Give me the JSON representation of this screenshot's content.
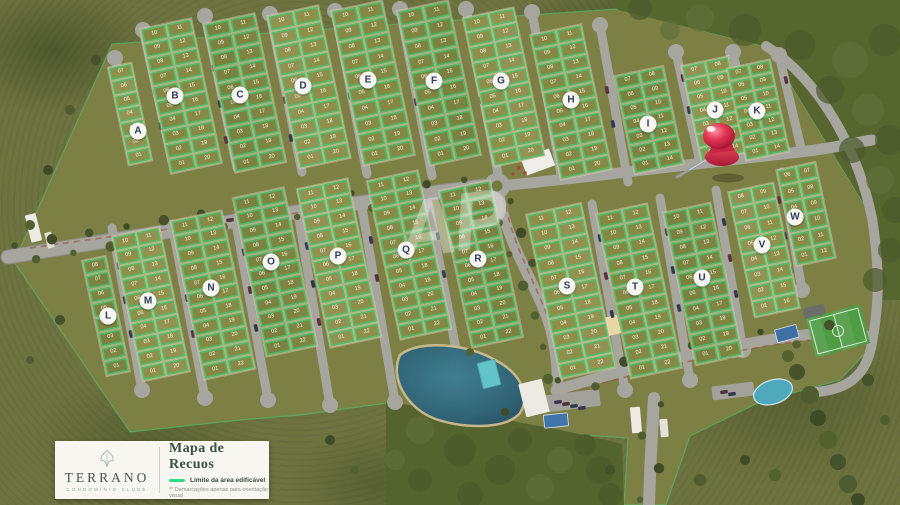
{
  "legend": {
    "brand": "TERRANO",
    "brand_tagline": "CONDOMÍNIO CLUBE",
    "brand_icon": "leaf-icon",
    "title": "Mapa de Recuos",
    "line_label": "Limite da área edificável",
    "note": "** Demarcações apenas para orientação visual"
  },
  "watermark": "AP",
  "pin": {
    "icon": "map-pin-icon",
    "color": "#d82f48"
  },
  "colors": {
    "limit_green": "#2fd987",
    "road_gray": "#a6a59e",
    "lot_olive": "#878a45",
    "lagoon_blue": "#2f6478",
    "field_green": "#4e9c44",
    "forest_dark": "#55632f"
  },
  "blocks": [
    {
      "label": "A",
      "cx": 130,
      "cy": 114,
      "w": 24,
      "h": 100,
      "rows": 7,
      "cols": 1,
      "mx": 138,
      "my": 131,
      "lots": [
        "07",
        "06",
        "05",
        "04",
        "03",
        "02",
        "01"
      ]
    },
    {
      "label": "B",
      "cx": 181,
      "cy": 96,
      "w": 52,
      "h": 148,
      "rows": 10,
      "cols": 2,
      "mx": 175,
      "my": 96,
      "lots": [
        "10",
        "11",
        "09",
        "12",
        "08",
        "13",
        "07",
        "14",
        "06",
        "15",
        "05",
        "16",
        "04",
        "17",
        "03",
        "18",
        "02",
        "19",
        "01",
        "20"
      ]
    },
    {
      "label": "C",
      "cx": 245,
      "cy": 93,
      "w": 52,
      "h": 152,
      "rows": 10,
      "cols": 2,
      "mx": 240,
      "my": 95,
      "lots": [
        "10",
        "11",
        "09",
        "12",
        "08",
        "13",
        "07",
        "14",
        "06",
        "15",
        "05",
        "16",
        "04",
        "17",
        "03",
        "18",
        "02",
        "19",
        "01",
        "20"
      ]
    },
    {
      "label": "D",
      "cx": 309,
      "cy": 87,
      "w": 52,
      "h": 156,
      "rows": 10,
      "cols": 2,
      "mx": 303,
      "my": 86,
      "lots": [
        "10",
        "11",
        "09",
        "12",
        "08",
        "13",
        "07",
        "14",
        "06",
        "15",
        "05",
        "16",
        "04",
        "17",
        "03",
        "18",
        "02",
        "19",
        "01",
        "20"
      ]
    },
    {
      "label": "E",
      "cx": 373,
      "cy": 83,
      "w": 52,
      "h": 158,
      "rows": 10,
      "cols": 2,
      "mx": 368,
      "my": 80,
      "lots": [
        "10",
        "11",
        "09",
        "12",
        "08",
        "13",
        "07",
        "14",
        "06",
        "15",
        "05",
        "16",
        "04",
        "17",
        "03",
        "18",
        "02",
        "19",
        "01",
        "20"
      ]
    },
    {
      "label": "F",
      "cx": 439,
      "cy": 83,
      "w": 52,
      "h": 158,
      "rows": 10,
      "cols": 2,
      "mx": 434,
      "my": 81,
      "lots": [
        "10",
        "11",
        "09",
        "12",
        "08",
        "13",
        "07",
        "14",
        "06",
        "15",
        "05",
        "16",
        "04",
        "17",
        "03",
        "18",
        "02",
        "19",
        "01",
        "20"
      ]
    },
    {
      "label": "G",
      "cx": 504,
      "cy": 87,
      "w": 52,
      "h": 152,
      "rows": 10,
      "cols": 2,
      "mx": 501,
      "my": 81,
      "lots": [
        "10",
        "11",
        "09",
        "12",
        "08",
        "13",
        "07",
        "14",
        "06",
        "15",
        "05",
        "16",
        "04",
        "17",
        "03",
        "18",
        "02",
        "19",
        "01",
        "20"
      ]
    },
    {
      "label": "H",
      "cx": 571,
      "cy": 102,
      "w": 52,
      "h": 148,
      "rows": 10,
      "cols": 2,
      "mx": 571,
      "my": 100,
      "lots": [
        "10",
        "11",
        "09",
        "12",
        "08",
        "13",
        "07",
        "14",
        "06",
        "15",
        "05",
        "16",
        "04",
        "17",
        "03",
        "18",
        "02",
        "19",
        "01",
        "20"
      ]
    },
    {
      "label": "I",
      "cx": 649,
      "cy": 120,
      "w": 50,
      "h": 100,
      "rows": 7,
      "cols": 2,
      "mx": 648,
      "my": 124,
      "lots": [
        "07",
        "08",
        "06",
        "09",
        "05",
        "10",
        "04",
        "11",
        "03",
        "12",
        "02",
        "13",
        "01",
        "14"
      ]
    },
    {
      "label": "J",
      "cx": 715,
      "cy": 109,
      "w": 48,
      "h": 98,
      "rows": 7,
      "cols": 2,
      "mx": 715,
      "my": 110,
      "lots": [
        "07",
        "08",
        "06",
        "09",
        "05",
        "10",
        "04",
        "11",
        "03",
        "12",
        "02",
        "13",
        "01",
        "14"
      ]
    },
    {
      "label": "K",
      "cx": 758,
      "cy": 110,
      "w": 44,
      "h": 94,
      "rows": 7,
      "cols": 2,
      "mx": 757,
      "my": 111,
      "lots": [
        "07",
        "08",
        "06",
        "09",
        "05",
        "10",
        "04",
        "11",
        "03",
        "12",
        "02",
        "13",
        "01",
        "14"
      ]
    },
    {
      "label": "L",
      "cx": 106,
      "cy": 316,
      "w": 24,
      "h": 118,
      "rows": 8,
      "cols": 1,
      "mx": 108,
      "my": 316,
      "lots": [
        "08",
        "07",
        "06",
        "05",
        "04",
        "03",
        "02",
        "01"
      ]
    },
    {
      "label": "M",
      "cx": 151,
      "cy": 304,
      "w": 48,
      "h": 148,
      "rows": 10,
      "cols": 2,
      "mx": 148,
      "my": 301,
      "lots": [
        "10",
        "11",
        "09",
        "12",
        "08",
        "13",
        "07",
        "14",
        "06",
        "15",
        "05",
        "16",
        "04",
        "17",
        "03",
        "18",
        "02",
        "19",
        "01",
        "20"
      ]
    },
    {
      "label": "N",
      "cx": 213,
      "cy": 295,
      "w": 52,
      "h": 162,
      "rows": 11,
      "cols": 2,
      "mx": 211,
      "my": 288,
      "lots": [
        "11",
        "12",
        "10",
        "13",
        "09",
        "14",
        "08",
        "15",
        "07",
        "16",
        "06",
        "17",
        "05",
        "18",
        "04",
        "19",
        "03",
        "20",
        "02",
        "21",
        "01",
        "22"
      ]
    },
    {
      "label": "O",
      "cx": 275,
      "cy": 272,
      "w": 52,
      "h": 162,
      "rows": 11,
      "cols": 2,
      "mx": 271,
      "my": 262,
      "lots": [
        "11",
        "12",
        "10",
        "13",
        "09",
        "14",
        "08",
        "15",
        "07",
        "16",
        "06",
        "17",
        "05",
        "18",
        "04",
        "19",
        "03",
        "20",
        "02",
        "21",
        "01",
        "22"
      ]
    },
    {
      "label": "P",
      "cx": 339,
      "cy": 263,
      "w": 52,
      "h": 162,
      "rows": 11,
      "cols": 2,
      "mx": 338,
      "my": 256,
      "lots": [
        "11",
        "12",
        "10",
        "13",
        "09",
        "14",
        "08",
        "15",
        "07",
        "16",
        "06",
        "17",
        "05",
        "18",
        "04",
        "19",
        "03",
        "20",
        "02",
        "21",
        "01",
        "22"
      ]
    },
    {
      "label": "Q",
      "cx": 409,
      "cy": 255,
      "w": 52,
      "h": 162,
      "rows": 11,
      "cols": 2,
      "mx": 406,
      "my": 250,
      "lots": [
        "11",
        "12",
        "10",
        "13",
        "09",
        "14",
        "08",
        "15",
        "07",
        "16",
        "06",
        "17",
        "05",
        "18",
        "04",
        "19",
        "03",
        "20",
        "02",
        "21",
        "01",
        "22"
      ]
    },
    {
      "label": "R",
      "cx": 481,
      "cy": 264,
      "w": 52,
      "h": 160,
      "rows": 11,
      "cols": 2,
      "mx": 478,
      "my": 259,
      "lots": [
        "11",
        "12",
        "10",
        "13",
        "09",
        "14",
        "08",
        "15",
        "07",
        "16",
        "06",
        "17",
        "05",
        "18",
        "04",
        "19",
        "03",
        "20",
        "02",
        "21",
        "01",
        "22"
      ]
    },
    {
      "label": "S",
      "cx": 571,
      "cy": 291,
      "w": 56,
      "h": 168,
      "rows": 11,
      "cols": 2,
      "mx": 567,
      "my": 286,
      "lots": [
        "11",
        "12",
        "10",
        "13",
        "09",
        "14",
        "08",
        "15",
        "07",
        "16",
        "06",
        "17",
        "05",
        "18",
        "04",
        "19",
        "03",
        "20",
        "02",
        "21",
        "01",
        "22"
      ]
    },
    {
      "label": "T",
      "cx": 639,
      "cy": 291,
      "w": 52,
      "h": 168,
      "rows": 11,
      "cols": 2,
      "mx": 635,
      "my": 287,
      "lots": [
        "11",
        "12",
        "10",
        "13",
        "09",
        "14",
        "08",
        "15",
        "07",
        "16",
        "06",
        "17",
        "05",
        "18",
        "04",
        "19",
        "03",
        "20",
        "02",
        "21",
        "01",
        "22"
      ]
    },
    {
      "label": "U",
      "cx": 703,
      "cy": 284,
      "w": 48,
      "h": 156,
      "rows": 10,
      "cols": 2,
      "mx": 702,
      "my": 278,
      "lots": [
        "10",
        "11",
        "09",
        "12",
        "08",
        "13",
        "07",
        "14",
        "06",
        "15",
        "05",
        "16",
        "04",
        "17",
        "03",
        "18",
        "02",
        "19",
        "01",
        "20"
      ]
    },
    {
      "label": "V",
      "cx": 764,
      "cy": 250,
      "w": 46,
      "h": 128,
      "rows": 8,
      "cols": 2,
      "mx": 762,
      "my": 245,
      "lots": [
        "08",
        "09",
        "07",
        "10",
        "06",
        "11",
        "05",
        "12",
        "04",
        "13",
        "03",
        "14",
        "02",
        "15",
        "01",
        "16"
      ]
    },
    {
      "label": "W",
      "cx": 806,
      "cy": 214,
      "w": 40,
      "h": 98,
      "rows": 6,
      "cols": 2,
      "mx": 795,
      "my": 217,
      "lots": [
        "06",
        "07",
        "05",
        "08",
        "04",
        "09",
        "03",
        "10",
        "02",
        "11",
        "01",
        "12"
      ]
    }
  ]
}
